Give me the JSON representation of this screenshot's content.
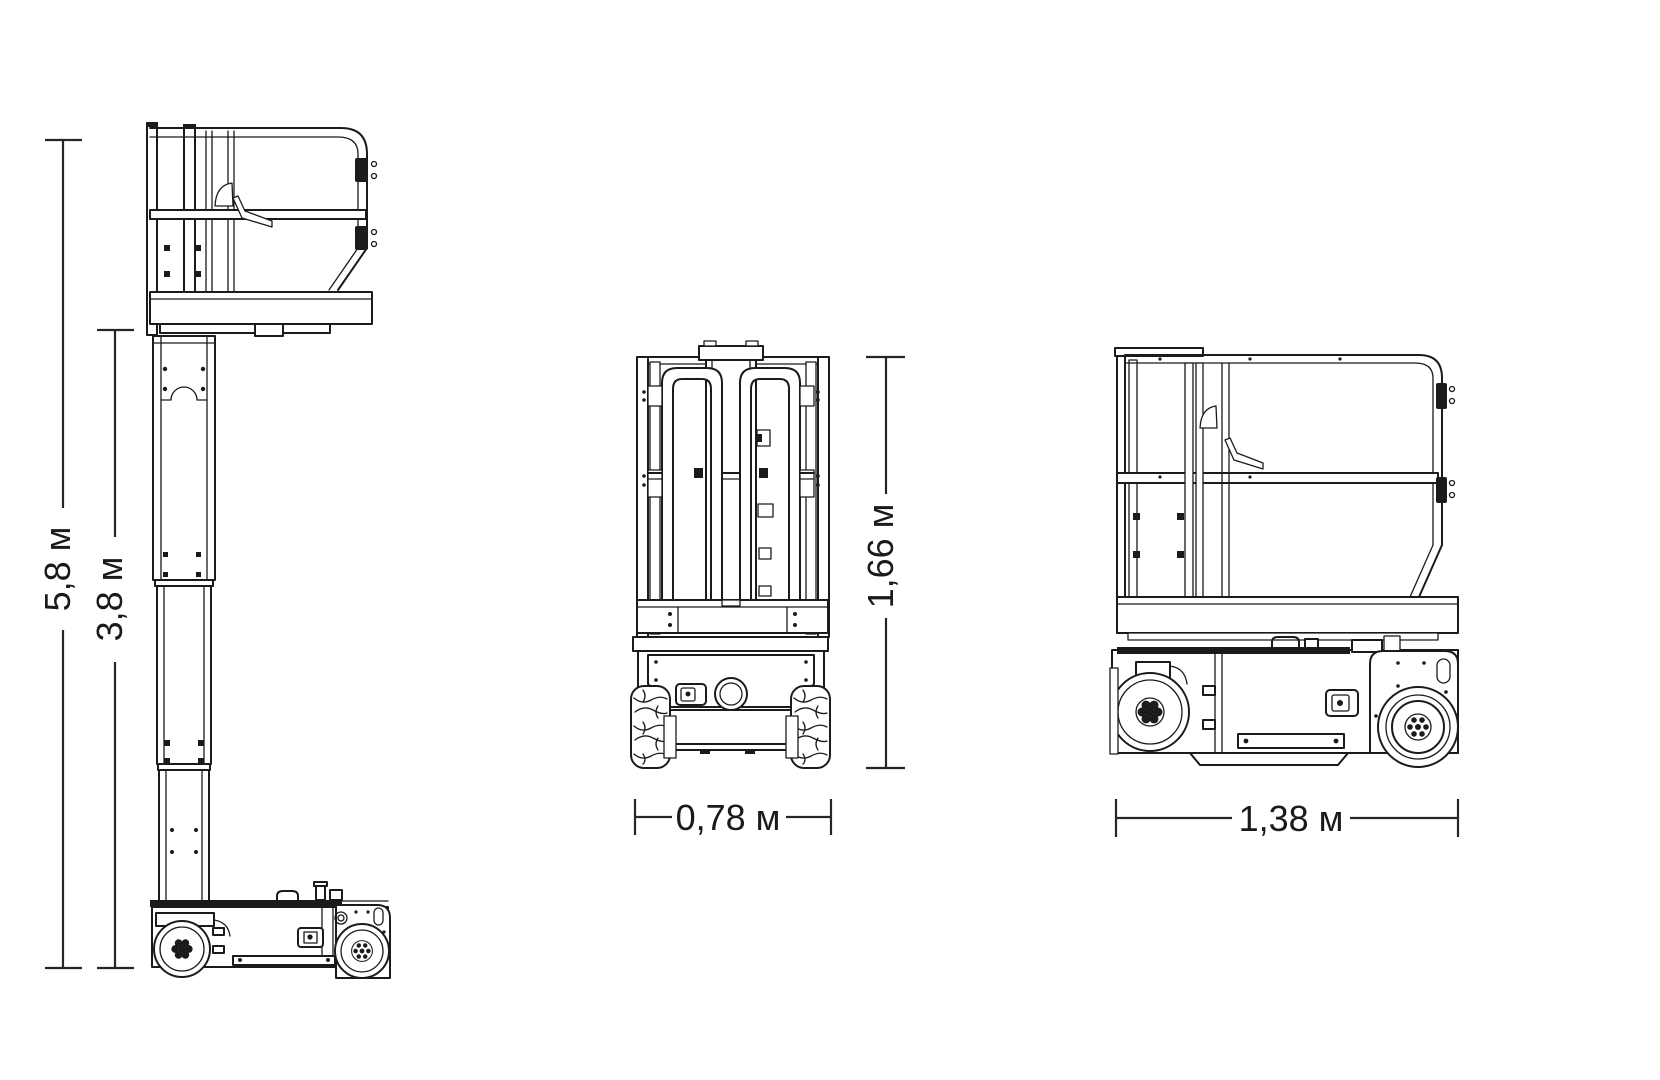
{
  "colors": {
    "background": "#ffffff",
    "line": "#1b1b1b",
    "dimension_line": "#262626",
    "text": "#1a1a1a"
  },
  "unit": "м",
  "views": {
    "side_extended": {
      "dims": {
        "overall_height": {
          "label": "5,8 м",
          "value": "5,8"
        },
        "platform_height": {
          "label": "3,8 м",
          "value": "3,8"
        }
      }
    },
    "front": {
      "dims": {
        "stowed_height": {
          "label": "1,66 м",
          "value": "1,66"
        },
        "overall_width": {
          "label": "0,78 м",
          "value": "0,78"
        }
      }
    },
    "side_stowed": {
      "dims": {
        "overall_length": {
          "label": "1,38 м",
          "value": "1,38"
        }
      }
    }
  }
}
